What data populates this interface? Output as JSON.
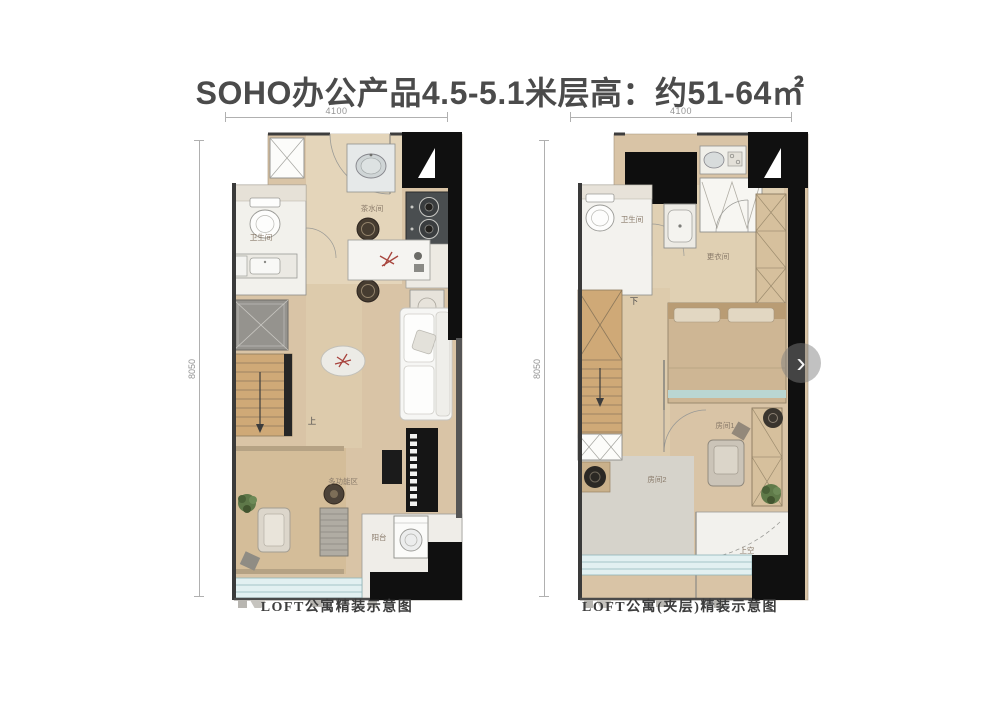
{
  "title": "SOHO办公产品4.5-5.1米层高：约51-64㎡",
  "left_plan": {
    "caption": "LOFT公寓精装示意图",
    "dim_top": "4100",
    "dim_side": "8050",
    "labels": {
      "bathroom": "卫生间",
      "tea_room": "茶水间",
      "multi_function": "多功能区",
      "balcony": "阳台",
      "stair_direction": "上"
    }
  },
  "right_plan": {
    "caption": "LOFT公寓(夹层)精装示意图",
    "dim_top": "4100",
    "dim_side": "8050",
    "labels": {
      "bathroom": "卫生间",
      "dressing_room": "更衣间",
      "room1": "房间1",
      "room2": "房间2",
      "void_above": "上空",
      "stair_direction": "下"
    }
  },
  "gallery": {
    "next_arrow": "›"
  },
  "colors": {
    "wall": "#111111",
    "wood_floor": "#d9c4a6",
    "window_glass": "#cde8ea",
    "title_text": "#4b4b4b"
  }
}
